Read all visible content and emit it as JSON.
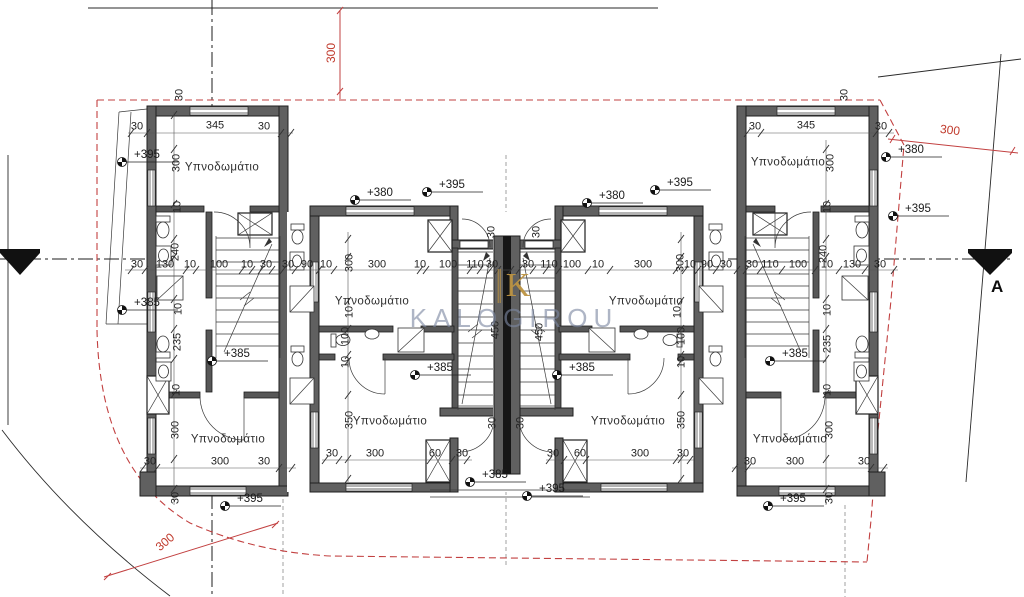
{
  "watermark": {
    "brand": "KALOGIROU",
    "logo_letter": "K",
    "text_color": "#7c88a2",
    "logo_color": "#bd9442"
  },
  "section": {
    "label": "A"
  },
  "rooms": {
    "bedroom": "Υπνοδωμάτιο"
  },
  "levels": {
    "p380": "+380",
    "p385": "+385",
    "p395": "+395"
  },
  "red_dims": {
    "top": "300",
    "right": "300",
    "bottom_left": "300"
  },
  "dims": {
    "d10": "10",
    "d30": "30",
    "d60": "60",
    "d90": "90",
    "d100": "100",
    "d110": "110",
    "d130": "130",
    "d235": "235",
    "d240": "240",
    "d300": "300",
    "d345": "345",
    "d350": "350",
    "d450": "450"
  },
  "colors": {
    "wall": "#606060",
    "wall_core": "#161616",
    "red": "#c24040",
    "dim_text": "#232323",
    "background": "#ffffff"
  }
}
